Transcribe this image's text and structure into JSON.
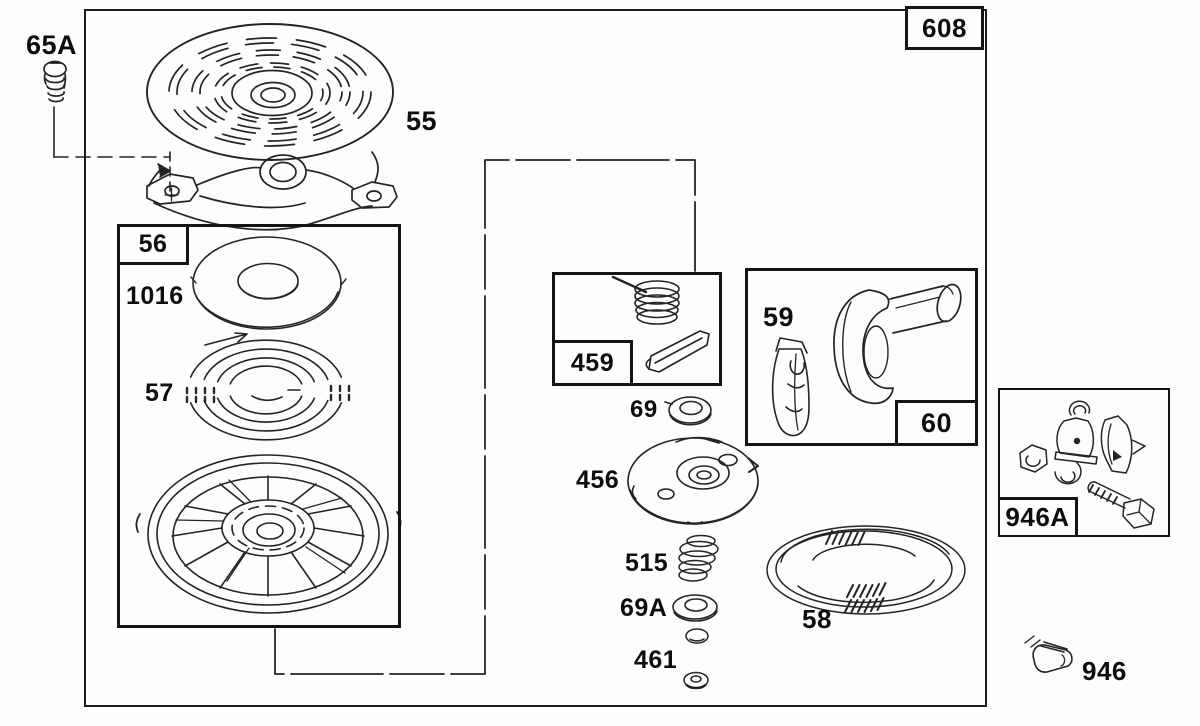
{
  "colors": {
    "background": "#fdfdfd",
    "ink": "#242424",
    "label_text": "#0d0d0d"
  },
  "labels": {
    "p608": "608",
    "p65A": "65A",
    "p55": "55",
    "p56": "56",
    "p1016": "1016",
    "p57": "57",
    "p459": "459",
    "p69": "69",
    "p59": "59",
    "p60": "60",
    "p456": "456",
    "p515": "515",
    "p69A": "69A",
    "p461": "461",
    "p58": "58",
    "p946A": "946A",
    "p946": "946"
  }
}
